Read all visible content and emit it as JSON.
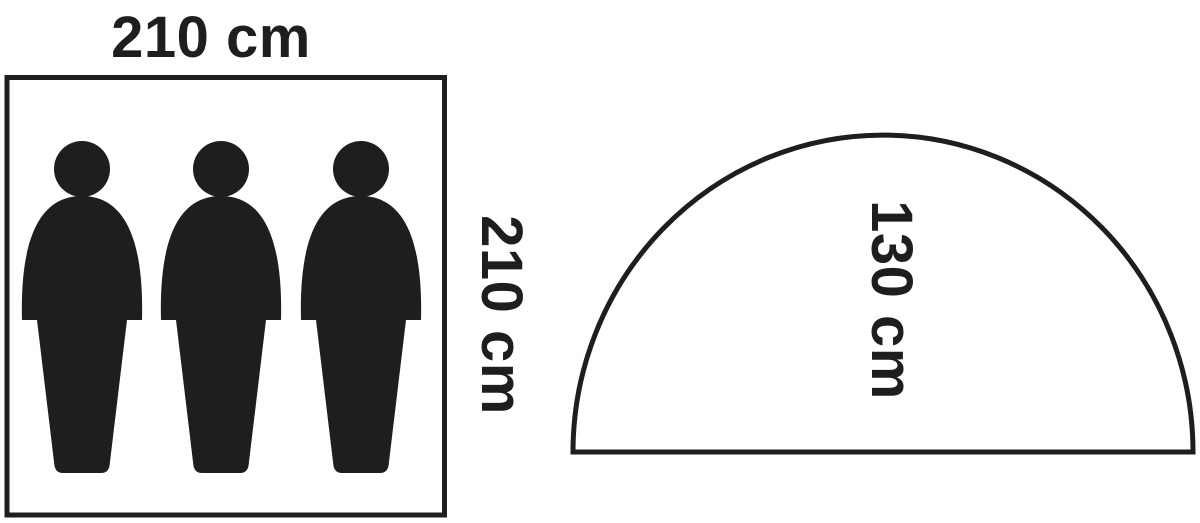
{
  "diagram_title": "tent-dimensions-pictogram",
  "colors": {
    "ink": "#1e1e1c",
    "background": "#ffffff"
  },
  "floor_plan": {
    "width_label": "210 cm",
    "depth_label": "210 cm",
    "occupant_icon": "person-silhouette-icon",
    "occupant_count": 3
  },
  "side_profile": {
    "shape": "dome-half-ellipse",
    "height_label": "130 cm"
  }
}
